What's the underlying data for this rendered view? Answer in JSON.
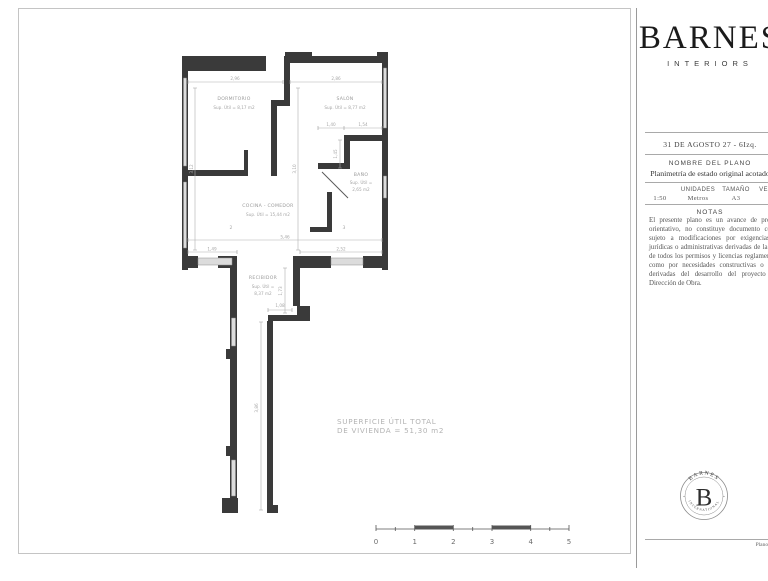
{
  "plan": {
    "rooms": {
      "dormitorio": {
        "name": "DORMITORIO",
        "area": "Sup. Útil = 8,17 m2"
      },
      "salon": {
        "name": "SALÓN",
        "area": "Sup. Útil = 8,77 m2"
      },
      "bano": {
        "name": "BAÑO",
        "area_l1": "Sup. Útil =",
        "area_l2": "2,65 m2"
      },
      "cocina": {
        "name": "COCINA - COMEDOR",
        "area": "Sup. Útil = 15,44 m2"
      },
      "recibidor": {
        "name": "RECIBIDOR",
        "area_l1": "Sup. Útil =",
        "area_l2": "8,37 m2"
      }
    },
    "total": {
      "line1": "SUPERFICIE ÚTIL TOTAL",
      "line2": "DE VIVIENDA = 51,30 m2"
    },
    "dims": {
      "d1": "2,96",
      "d2": "2,86",
      "d3": "3,12",
      "d4": "3,10",
      "d5": "1,40",
      "d6": "1,54",
      "d7": "1,45",
      "d8": "5,46",
      "d9": "1,49",
      "d10": "2,52",
      "d11": "1,73",
      "d12": "1,08",
      "d13": "3,86",
      "n1": "2",
      "n2": "3"
    },
    "scale_bar": {
      "labels": [
        "0",
        "1",
        "2",
        "3",
        "4",
        "5"
      ]
    },
    "colors": {
      "wall": "#3a3a3a",
      "window": "#dcdcdc",
      "dimline": "#b0b0b0"
    }
  },
  "titleblock": {
    "brand": "BARNES",
    "brand_sub": "INTERIORS",
    "address": "31 DE AGOSTO 27 - 6Izq.",
    "name_label": "NOMBRE DEL PLANO",
    "plan_name": "Planimetría de estado original acotado",
    "table": {
      "h1": "",
      "h2": "UNIDADES",
      "h3": "TAMAÑO",
      "h4": "VERSIÓN",
      "v1": "1:50",
      "v2": "Metros",
      "v3": "A3",
      "v4": "01"
    },
    "notes_label": "NOTAS",
    "notes": "El presente plano es un avance de proyecto, es orientativo, no constituye documento contractual; sujeto a modificaciones por exigencias técnicas jurídicas o administrativas derivadas de la obtención de todos los permisos y licencias reglamentarias, así como por necesidades constructivas o de diseño derivadas del desarrollo del proyecto y de la Dirección de Obra.",
    "stamp": {
      "arc_top": "BARNES",
      "letter": "B",
      "arc_bottom": "INTERNATIONAL",
      "sep_left": "·",
      "sep_right": "·"
    },
    "footer": "Plano 01"
  }
}
